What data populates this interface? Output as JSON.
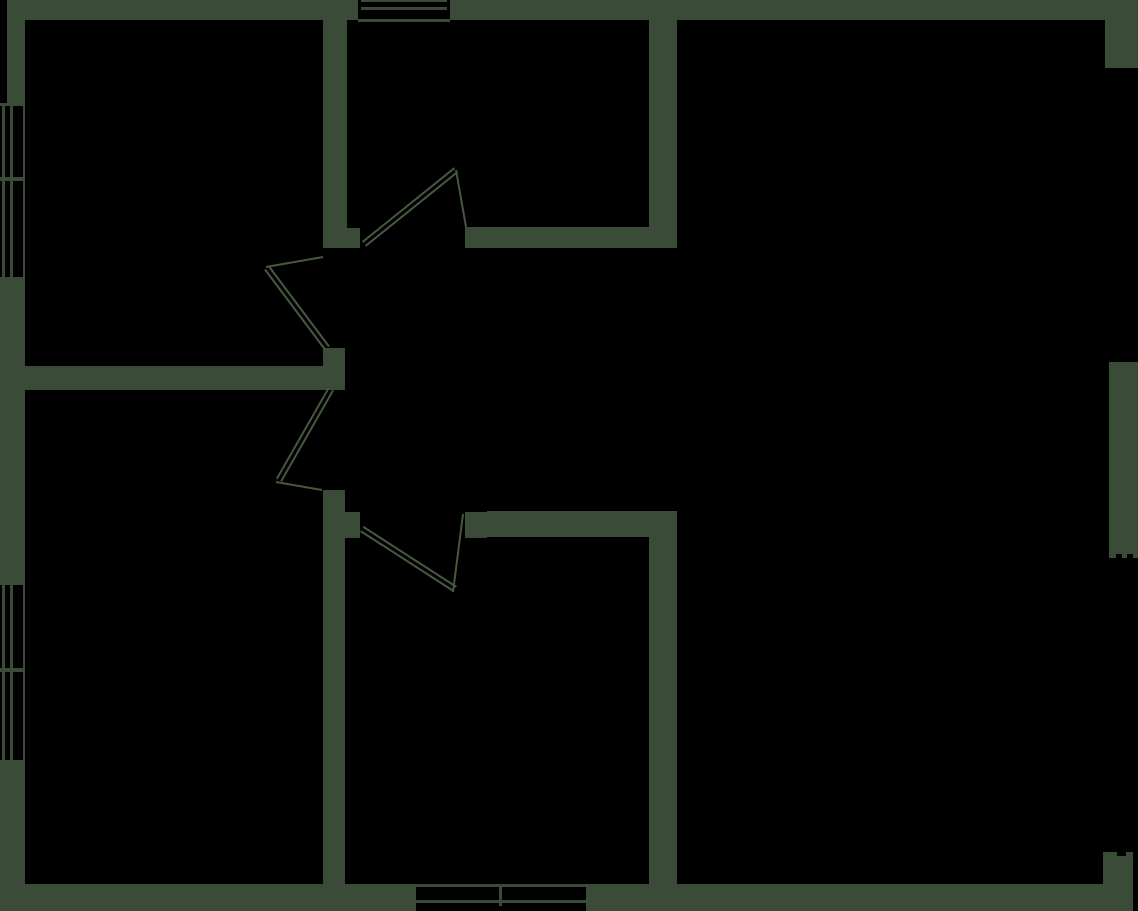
{
  "canvas": {
    "width": 1138,
    "height": 911,
    "background": "#000000",
    "wall_color": "#3a4b38",
    "line_color": "#46583f",
    "line_width": 2,
    "door_leaf_gap": 5
  },
  "shapes": [
    {
      "name": "top-wall",
      "type": "rect",
      "fill": "wall",
      "x": 7,
      "y": 0,
      "w": 1131,
      "h": 20
    },
    {
      "name": "left-wall-upper",
      "type": "rect",
      "fill": "wall",
      "x": 7,
      "y": 20,
      "w": 18,
      "h": 83
    },
    {
      "name": "left-wall-middle",
      "type": "rect",
      "fill": "wall",
      "x": 0,
      "y": 280,
      "w": 25,
      "h": 302
    },
    {
      "name": "left-wall-lower",
      "type": "rect",
      "fill": "wall",
      "x": 0,
      "y": 763,
      "w": 25,
      "h": 121
    },
    {
      "name": "bottom-wall-left",
      "type": "rect",
      "fill": "wall",
      "x": 0,
      "y": 884,
      "w": 416,
      "h": 27
    },
    {
      "name": "bottom-wall-right",
      "type": "rect",
      "fill": "wall",
      "x": 586,
      "y": 884,
      "w": 547,
      "h": 27
    },
    {
      "name": "right-wall-top-corner",
      "type": "rect",
      "fill": "wall",
      "x": 1105,
      "y": 20,
      "w": 33,
      "h": 48
    },
    {
      "name": "right-wall-middle",
      "type": "rect",
      "fill": "wall",
      "x": 1109,
      "y": 362,
      "w": 29,
      "h": 196
    },
    {
      "name": "right-wall-bottom-corner",
      "type": "rect",
      "fill": "wall",
      "x": 1103,
      "y": 852,
      "w": 30,
      "h": 32
    },
    {
      "name": "interior-wall-v1-upper",
      "type": "rect",
      "fill": "wall",
      "x": 323,
      "y": 20,
      "w": 24,
      "h": 208
    },
    {
      "name": "door1-left-jamb",
      "type": "rect",
      "fill": "wall",
      "x": 323,
      "y": 228,
      "w": 37,
      "h": 20
    },
    {
      "name": "door2-bottom-jamb",
      "type": "rect",
      "fill": "wall",
      "x": 323,
      "y": 348,
      "w": 22,
      "h": 18
    },
    {
      "name": "interior-wall-h1",
      "type": "rect",
      "fill": "wall",
      "x": 25,
      "y": 366,
      "w": 320,
      "h": 24
    },
    {
      "name": "interior-wall-v1-lower",
      "type": "rect",
      "fill": "wall",
      "x": 323,
      "y": 490,
      "w": 22,
      "h": 394
    },
    {
      "name": "door4-left-jamb",
      "type": "rect",
      "fill": "wall",
      "x": 345,
      "y": 512,
      "w": 15,
      "h": 26
    },
    {
      "name": "door4-right-jamb",
      "type": "rect",
      "fill": "wall",
      "x": 465,
      "y": 512,
      "w": 22,
      "h": 26
    },
    {
      "name": "interior-wall-h2",
      "type": "rect",
      "fill": "wall",
      "x": 465,
      "y": 227,
      "w": 212,
      "h": 21
    },
    {
      "name": "interior-wall-v2-upper",
      "type": "rect",
      "fill": "wall",
      "x": 649,
      "y": 20,
      "w": 28,
      "h": 227
    },
    {
      "name": "interior-wall-h3",
      "type": "rect",
      "fill": "wall",
      "x": 487,
      "y": 511,
      "w": 190,
      "h": 26
    },
    {
      "name": "interior-wall-v2-lower",
      "type": "rect",
      "fill": "wall",
      "x": 649,
      "y": 537,
      "w": 28,
      "h": 347
    },
    {
      "name": "top-window-opening",
      "type": "rect",
      "fill": "bg",
      "x": 358,
      "y": 0,
      "w": 92,
      "h": 22
    },
    {
      "name": "top-window-outer-line",
      "type": "rect",
      "fill": "wall",
      "x": 361,
      "y": 0,
      "w": 86,
      "h": 2
    },
    {
      "name": "top-window-glass-line",
      "type": "rect",
      "fill": "wall",
      "x": 361,
      "y": 7,
      "w": 86,
      "h": 3
    },
    {
      "name": "top-window-sill-line",
      "type": "rect",
      "fill": "wall",
      "x": 358,
      "y": 19,
      "w": 92,
      "h": 3
    },
    {
      "name": "left-window1-opening",
      "type": "rect",
      "fill": "bg",
      "x": 0,
      "y": 103,
      "w": 23,
      "h": 177
    },
    {
      "name": "left-window1-inner-face",
      "type": "rect",
      "fill": "wall",
      "x": 23,
      "y": 103,
      "w": 2,
      "h": 177
    },
    {
      "name": "left-window1-top-cap",
      "type": "rect",
      "fill": "wall",
      "x": 0,
      "y": 103,
      "w": 23,
      "h": 3
    },
    {
      "name": "left-window1-bottom-cap",
      "type": "rect",
      "fill": "wall",
      "x": 0,
      "y": 277,
      "w": 23,
      "h": 3
    },
    {
      "name": "left-window1-outer-glass",
      "type": "rect",
      "fill": "wall",
      "x": 2,
      "y": 103,
      "w": 3,
      "h": 177
    },
    {
      "name": "left-window1-inner-glass",
      "type": "rect",
      "fill": "wall",
      "x": 10,
      "y": 103,
      "w": 3,
      "h": 177
    },
    {
      "name": "left-window1-mullion",
      "type": "rect",
      "fill": "wall",
      "x": 0,
      "y": 177,
      "w": 25,
      "h": 4
    },
    {
      "name": "left-window2-opening",
      "type": "rect",
      "fill": "bg",
      "x": 0,
      "y": 582,
      "w": 23,
      "h": 181
    },
    {
      "name": "left-window2-inner-face",
      "type": "rect",
      "fill": "wall",
      "x": 23,
      "y": 582,
      "w": 2,
      "h": 181
    },
    {
      "name": "left-window2-top-cap",
      "type": "rect",
      "fill": "wall",
      "x": 0,
      "y": 582,
      "w": 23,
      "h": 3
    },
    {
      "name": "left-window2-bottom-cap",
      "type": "rect",
      "fill": "wall",
      "x": 0,
      "y": 760,
      "w": 23,
      "h": 3
    },
    {
      "name": "left-window2-outer-glass",
      "type": "rect",
      "fill": "wall",
      "x": 2,
      "y": 582,
      "w": 3,
      "h": 181
    },
    {
      "name": "left-window2-inner-glass",
      "type": "rect",
      "fill": "wall",
      "x": 10,
      "y": 582,
      "w": 3,
      "h": 181
    },
    {
      "name": "left-window2-mullion",
      "type": "rect",
      "fill": "wall",
      "x": 0,
      "y": 668,
      "w": 25,
      "h": 4
    },
    {
      "name": "bottom-window-opening",
      "type": "rect",
      "fill": "bg",
      "x": 416,
      "y": 884,
      "w": 170,
      "h": 22
    },
    {
      "name": "bottom-window-outer-line",
      "type": "rect",
      "fill": "wall",
      "x": 416,
      "y": 884,
      "w": 170,
      "h": 3
    },
    {
      "name": "bottom-window-glass-line",
      "type": "rect",
      "fill": "wall",
      "x": 416,
      "y": 900,
      "w": 170,
      "h": 3
    },
    {
      "name": "bottom-window-mullion",
      "type": "rect",
      "fill": "wall",
      "x": 499,
      "y": 884,
      "w": 3,
      "h": 22
    },
    {
      "name": "right-wall-notch-1",
      "type": "rect",
      "fill": "bg",
      "x": 1116,
      "y": 554,
      "w": 6,
      "h": 5
    },
    {
      "name": "right-wall-notch-2",
      "type": "rect",
      "fill": "bg",
      "x": 1127,
      "y": 554,
      "w": 6,
      "h": 5
    },
    {
      "name": "bottom-corner-notch",
      "type": "rect",
      "fill": "bg",
      "x": 1117,
      "y": 852,
      "w": 9,
      "h": 4
    },
    {
      "name": "door1-panel",
      "type": "dline",
      "x1": 364,
      "y1": 244,
      "x2": 456,
      "y2": 170
    },
    {
      "name": "door1-swing",
      "type": "line",
      "x1": 456,
      "y1": 170,
      "x2": 466,
      "y2": 227
    },
    {
      "name": "door2-panel",
      "type": "dline",
      "x1": 327,
      "y1": 348,
      "x2": 267,
      "y2": 268
    },
    {
      "name": "door2-swing",
      "type": "line",
      "x1": 266,
      "y1": 267,
      "x2": 323,
      "y2": 257
    },
    {
      "name": "door3-panel",
      "type": "dline",
      "x1": 331,
      "y1": 389,
      "x2": 279,
      "y2": 480
    },
    {
      "name": "door3-swing",
      "type": "line",
      "x1": 276,
      "y1": 482,
      "x2": 322,
      "y2": 490
    },
    {
      "name": "door4-panel",
      "type": "dline",
      "x1": 362,
      "y1": 529,
      "x2": 455,
      "y2": 589
    },
    {
      "name": "door4-swing",
      "type": "line",
      "x1": 453,
      "y1": 592,
      "x2": 463,
      "y2": 514
    }
  ]
}
